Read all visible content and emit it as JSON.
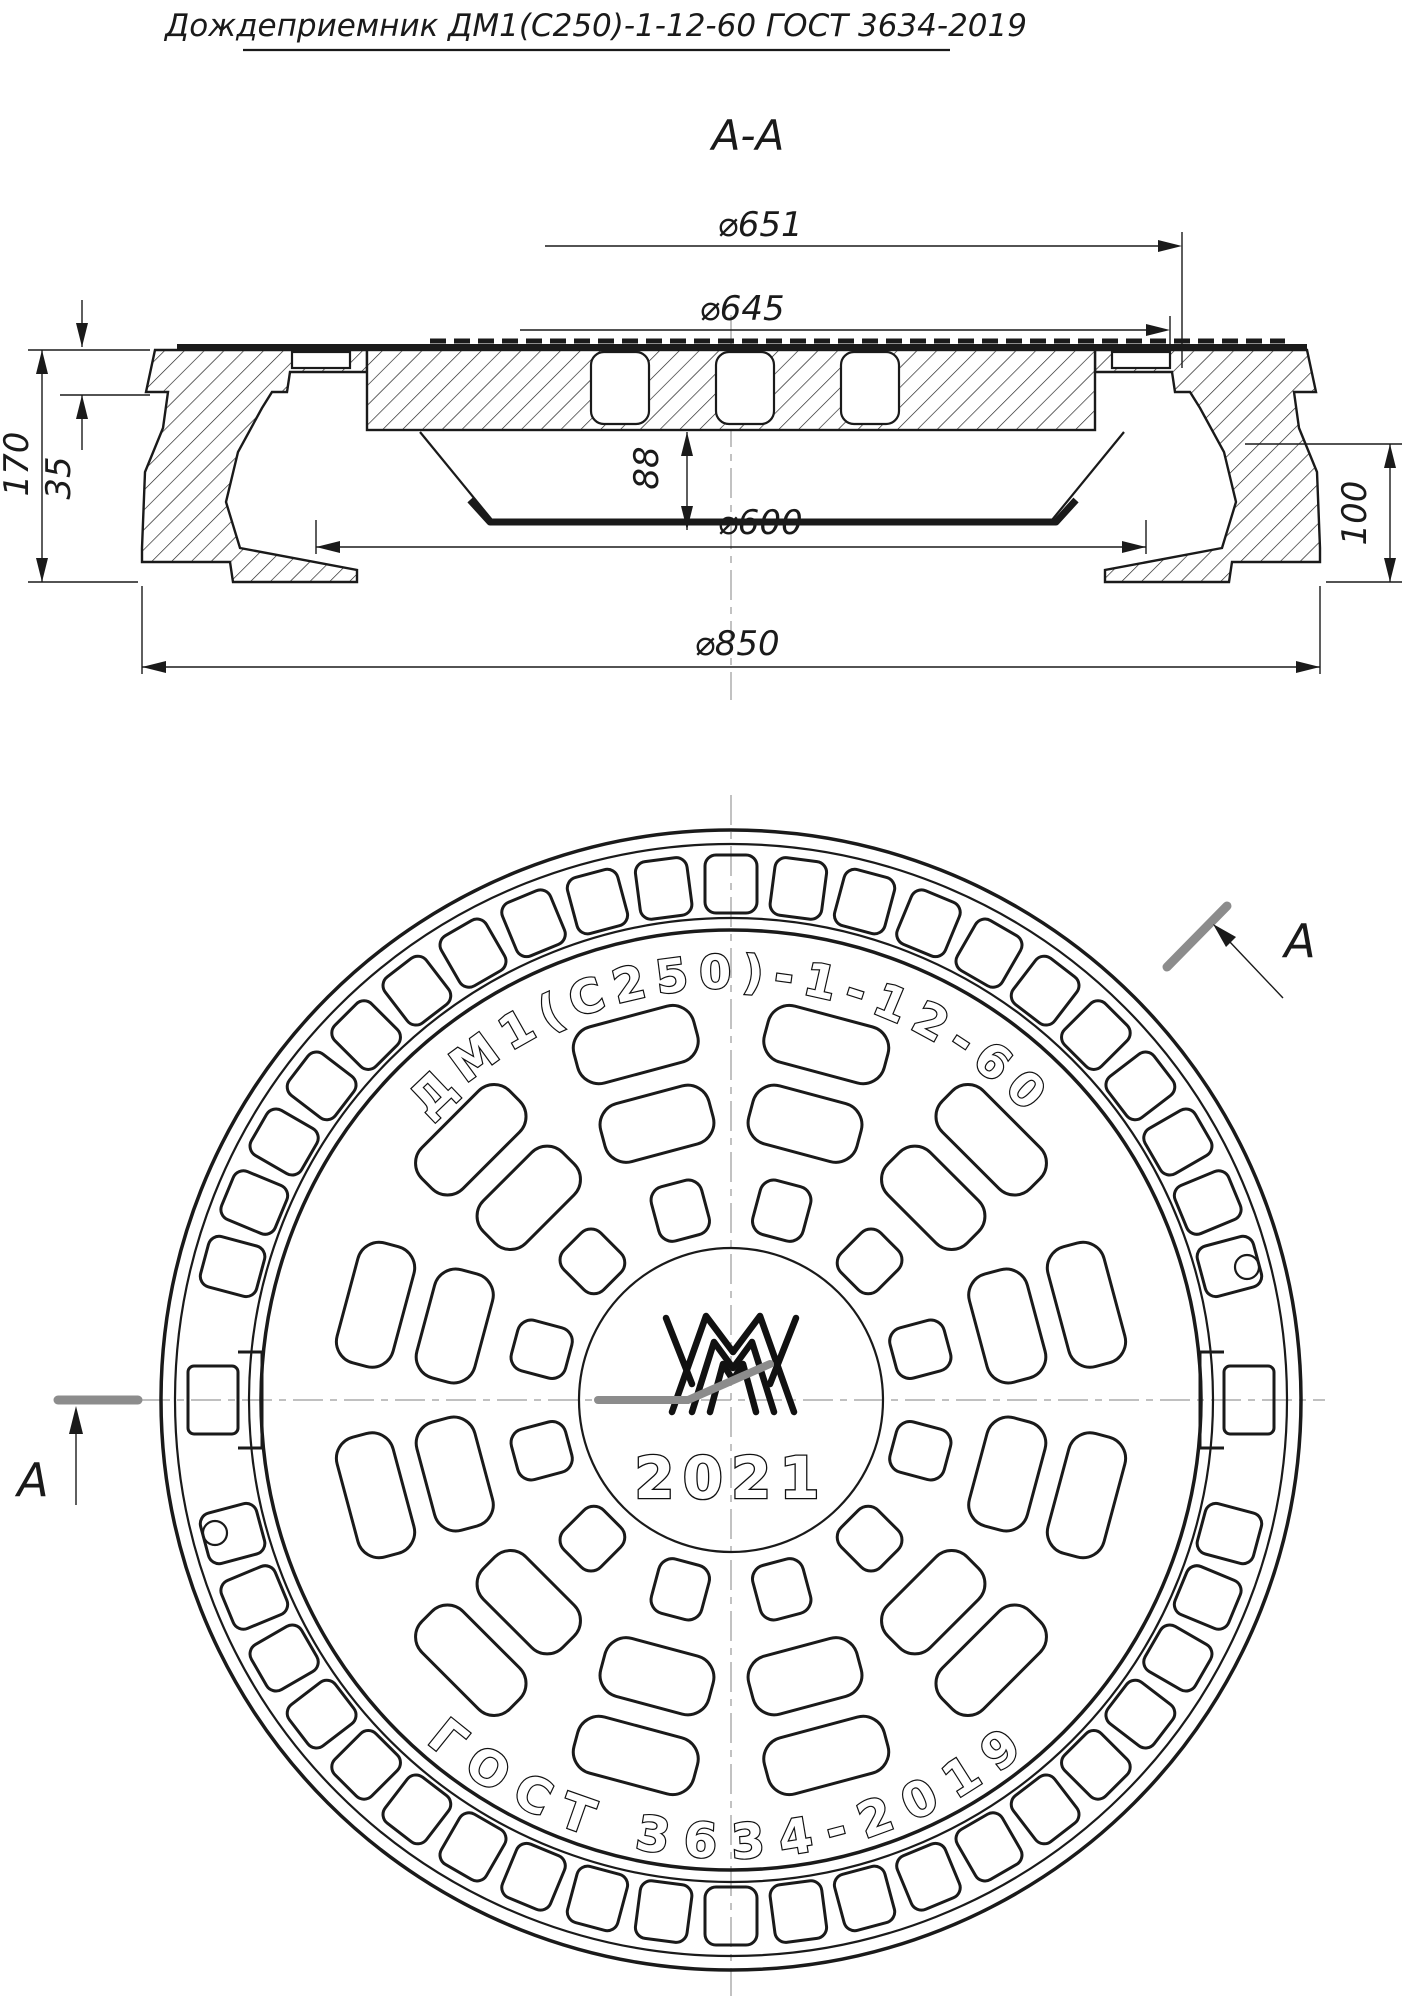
{
  "title": "Дождеприемник ДМ1(С250)-1-12-60  ГОСТ 3634-2019",
  "section_view": {
    "label": "А-А",
    "dimensions": {
      "d651": "⌀651",
      "d645": "⌀645",
      "d600": "⌀600",
      "d850": "⌀850",
      "h170": "170",
      "h35": "35",
      "h88": "88",
      "h100": "100"
    }
  },
  "plan_view": {
    "cut_label": "А",
    "top_marking": "ДМ1(С250)-1-12-60",
    "bottom_marking": "ГОСТ 3634-2019",
    "year": "2021"
  },
  "colors": {
    "line": "#1a1a1a",
    "cut_plane_mark": "#8c8c8c",
    "centerline": "#9a9a9a",
    "background": "#ffffff"
  }
}
